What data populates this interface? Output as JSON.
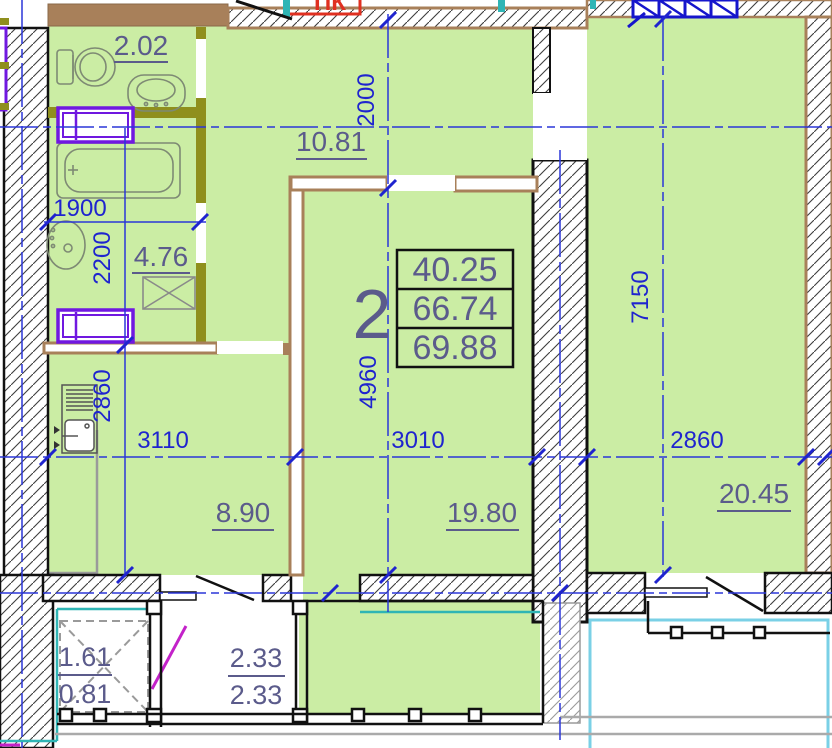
{
  "plan_type": "apartment floor plan",
  "summary": {
    "rooms_count": "2",
    "living_area": "40.25",
    "apartment_area": "66.74",
    "total_area": "69.88"
  },
  "areas": {
    "bath_small": "2.02",
    "bath": "4.76",
    "hall": "10.81",
    "kitchen": "8.90",
    "living": "19.80",
    "bedroom": "20.45",
    "balcony_a_top": "1.61",
    "balcony_a_bottom": "0.81",
    "balcony_b_top": "2.33",
    "balcony_b_bottom": "2.33"
  },
  "dims": {
    "hall_width": "2000",
    "bath_width": "1900",
    "bath_height": "2200",
    "kitchen_depth": "2860",
    "kitchen_width": "3110",
    "living_width": "3010",
    "living_depth": "4960",
    "bedroom_depth": "7150",
    "bedroom_width": "2860"
  },
  "annotations": {
    "duct": "ПК"
  },
  "colors": {
    "room_fill": "#cbeda4",
    "partition_brown": "#a8805a",
    "door_frame_olive": "#8f8f1d",
    "radiator_purple": "#7018e0",
    "dimension_blue": "#1f24cf",
    "area_text": "#5b5b8b",
    "glazing_teal": "#2fb5b5",
    "balcony_cyan": "#7ad0e6",
    "duct_red": "#e03020"
  }
}
